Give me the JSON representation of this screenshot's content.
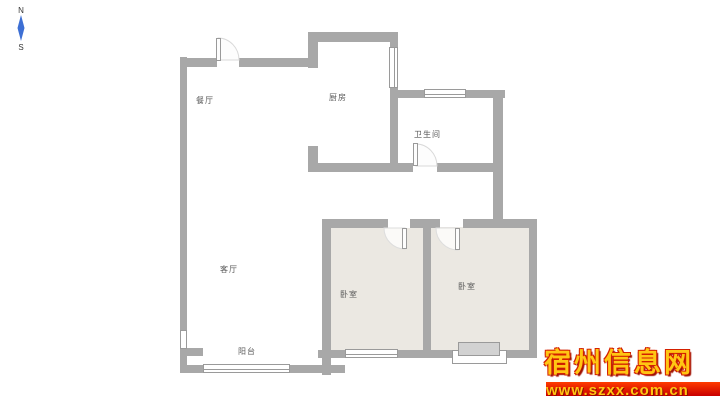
{
  "compass": {
    "north": "N",
    "south": "S"
  },
  "rooms": [
    {
      "name": "dining-room",
      "label": "餐厅"
    },
    {
      "name": "kitchen",
      "label": "厨房"
    },
    {
      "name": "bathroom",
      "label": "卫生间"
    },
    {
      "name": "living-room",
      "label": "客厅"
    },
    {
      "name": "bedroom-left",
      "label": "卧室"
    },
    {
      "name": "bedroom-right",
      "label": "卧室"
    },
    {
      "name": "balcony",
      "label": "阳台"
    }
  ],
  "watermark": {
    "site_name": "宿州信息网",
    "site_url": "www.szxx.com.cn"
  },
  "colors": {
    "wall": "#a8a8a8",
    "room_fill": "#ebe8e2",
    "bay_fill": "#d2d2d2",
    "compass_needle": "#3d6fd4",
    "wm_gold": "#ffc613",
    "wm_red": "#d42000",
    "wm_banner_top": "#ff3c00",
    "wm_banner_bottom": "#c80000"
  }
}
